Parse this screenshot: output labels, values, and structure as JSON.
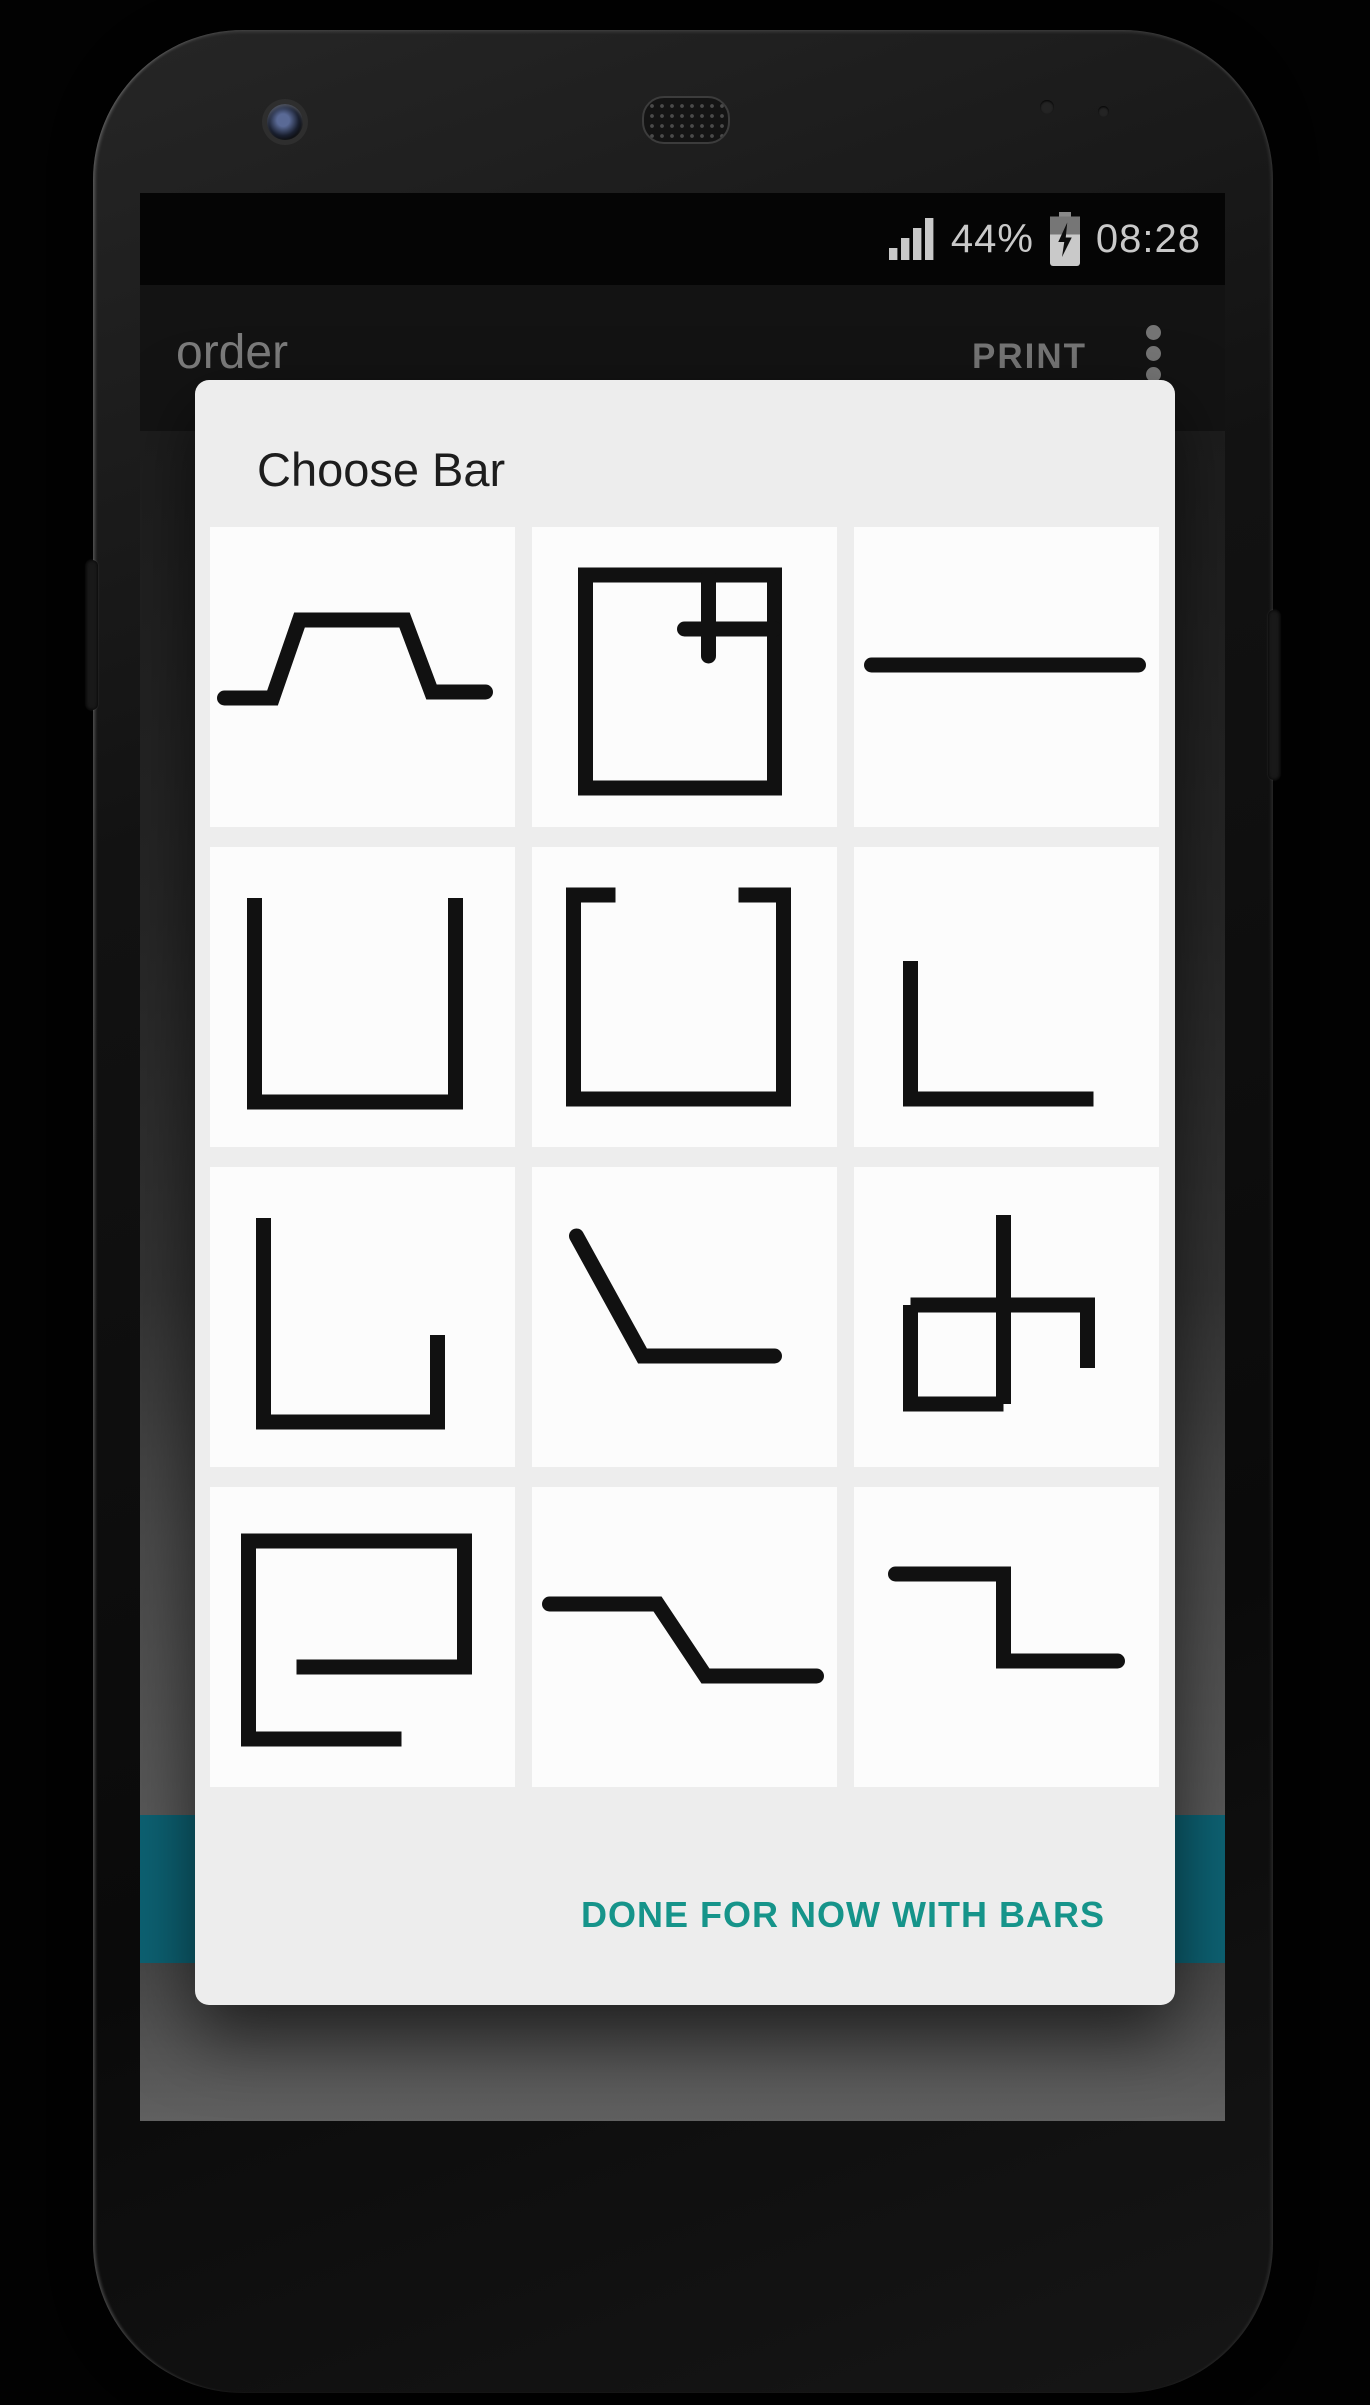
{
  "status_bar": {
    "battery_percent": "44%",
    "time": "08:28",
    "signal_icon": "signal-strength-4-bars",
    "battery_icon": "battery-charging"
  },
  "app_bar": {
    "title": "order",
    "action": "PRINT",
    "overflow_icon": "vertical-ellipsis-menu"
  },
  "dialog": {
    "title": "Choose Bar",
    "done_button": "DONE FOR NOW WITH BARS",
    "bars": [
      {
        "name": "plateau",
        "strokes": [
          {
            "points": "4,57 20,57 29,31 64,31 73,55 91,55",
            "cap": "round"
          }
        ]
      },
      {
        "name": "boxed-corner-cross",
        "strokes": [
          {
            "points": "17,16 80,16 80,87 17,87",
            "closed": true,
            "cap": "butt"
          },
          {
            "points": "58,16 58,43",
            "cap": "round"
          },
          {
            "points": "50,34 80,34",
            "cap": "round"
          }
        ]
      },
      {
        "name": "horizontal-line",
        "strokes": [
          {
            "points": "5,46 94,46",
            "cap": "round"
          }
        ]
      },
      {
        "name": "open-top-box",
        "strokes": [
          {
            "points": "14,17 14,85 81,85 81,17",
            "cap": "butt"
          }
        ]
      },
      {
        "name": "open-top-box-lips",
        "strokes": [
          {
            "points": "27,16 13,16 13,84 83,84 83,16 68,16",
            "cap": "butt"
          }
        ]
      },
      {
        "name": "low-corner",
        "strokes": [
          {
            "points": "18,38 18,84 79,84",
            "cap": "butt"
          }
        ]
      },
      {
        "name": "tub-short-right",
        "strokes": [
          {
            "points": "17,17 17,85 75,85 75,56",
            "cap": "butt"
          }
        ]
      },
      {
        "name": "slope-then-flat",
        "strokes": [
          {
            "points": "14,23 36,63 80,63",
            "cap": "round"
          }
        ]
      },
      {
        "name": "box-stem-hook",
        "strokes": [
          {
            "points": "49,16 49,79",
            "cap": "butt"
          },
          {
            "points": "18,46 18,79 49,79",
            "cap": "butt"
          },
          {
            "points": "18,46 77,46 77,67",
            "cap": "butt"
          }
        ]
      },
      {
        "name": "inward-spiral",
        "strokes": [
          {
            "points": "28,60 84,60 84,18 12,18 12,84 63,84",
            "cap": "butt"
          }
        ]
      },
      {
        "name": "flat-slope-flat",
        "strokes": [
          {
            "points": "5,39 41,39 57,63 94,63",
            "cap": "round"
          }
        ]
      },
      {
        "name": "step-down",
        "strokes": [
          {
            "points": "13,29 49,29 49,58 87,58",
            "cap": "round"
          }
        ]
      }
    ]
  },
  "colors": {
    "accent": "#16948A",
    "teal_bar": "#0D6273",
    "bar_stroke": "#111111",
    "dialog_bg": "#EDEDED",
    "status_text": "#C9C9C9"
  }
}
